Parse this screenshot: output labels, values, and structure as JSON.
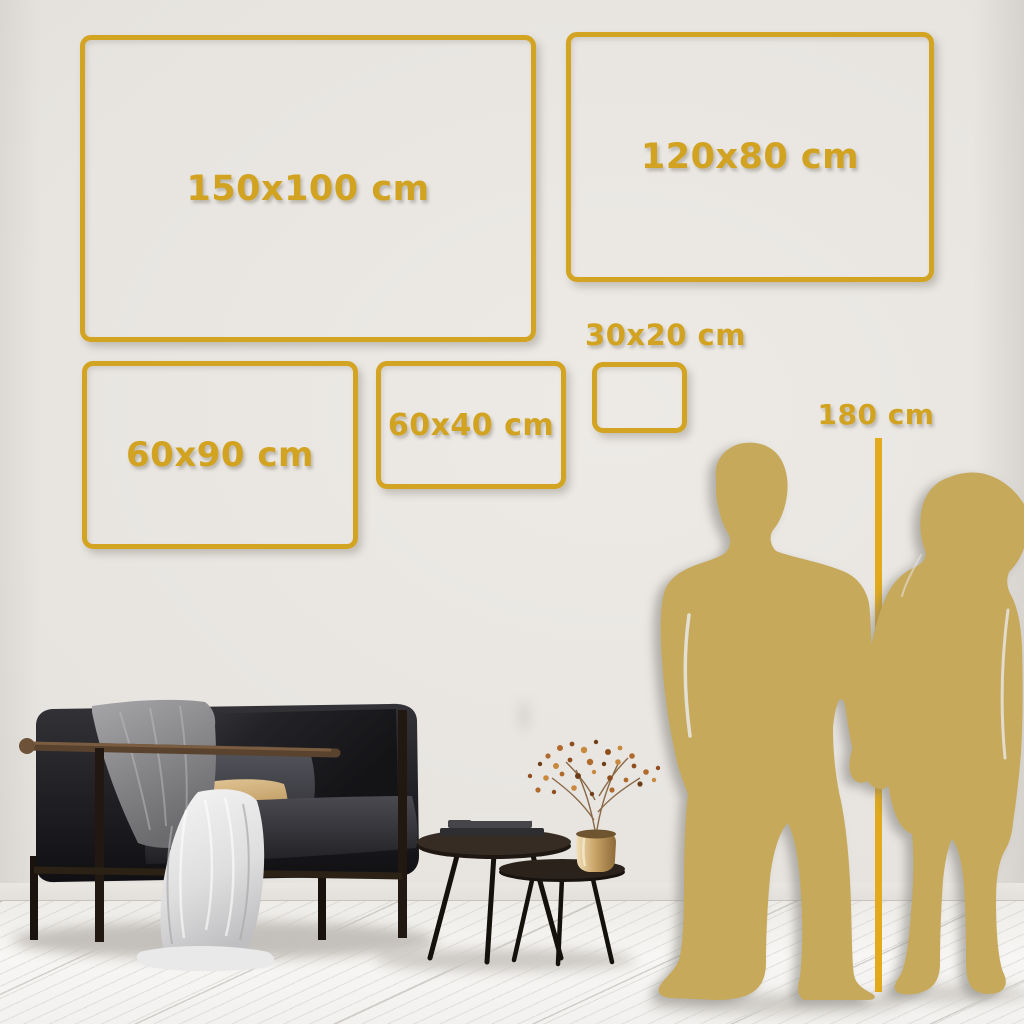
{
  "scene": {
    "name": "wall-art-size-comparison-guide",
    "setting": "living room wall with sofa, nesting coffee tables and couple silhouettes for scale"
  },
  "sizes": {
    "unit": "cm",
    "items": [
      {
        "id": "150x100",
        "label": "150x100 cm",
        "width_cm": 150,
        "height_cm": 100
      },
      {
        "id": "120x80",
        "label": "120x80 cm",
        "width_cm": 120,
        "height_cm": 80
      },
      {
        "id": "60x90",
        "label": "60x90 cm",
        "width_cm": 60,
        "height_cm": 90
      },
      {
        "id": "60x40",
        "label": "60x40 cm",
        "width_cm": 60,
        "height_cm": 40
      },
      {
        "id": "30x20",
        "label": "30x20 cm",
        "width_cm": 30,
        "height_cm": 20
      }
    ]
  },
  "height_marker": {
    "label": "180 cm",
    "value_cm": 180
  },
  "colors": {
    "frame_gold": "#d3a322",
    "text_gold": "#d2a321",
    "marker_line_gold": "#e2aa1c",
    "silhouette_gold": "#c6a95b",
    "wall": "#e7e4e0",
    "floor": "#f5f4f2"
  },
  "decor": {
    "man": "man-silhouette",
    "woman": "woman-silhouette",
    "sofa": "black-velvet-sofa",
    "blanket": "gray-throw-blanket",
    "drape": "white-throw-blanket",
    "pillow_dark": "dark-gray-pillow",
    "pillow_tan": "tan-pillow",
    "tables": "nesting-coffee-tables",
    "books": "book-stack",
    "plant": "dried-branch-in-brass-pot"
  }
}
